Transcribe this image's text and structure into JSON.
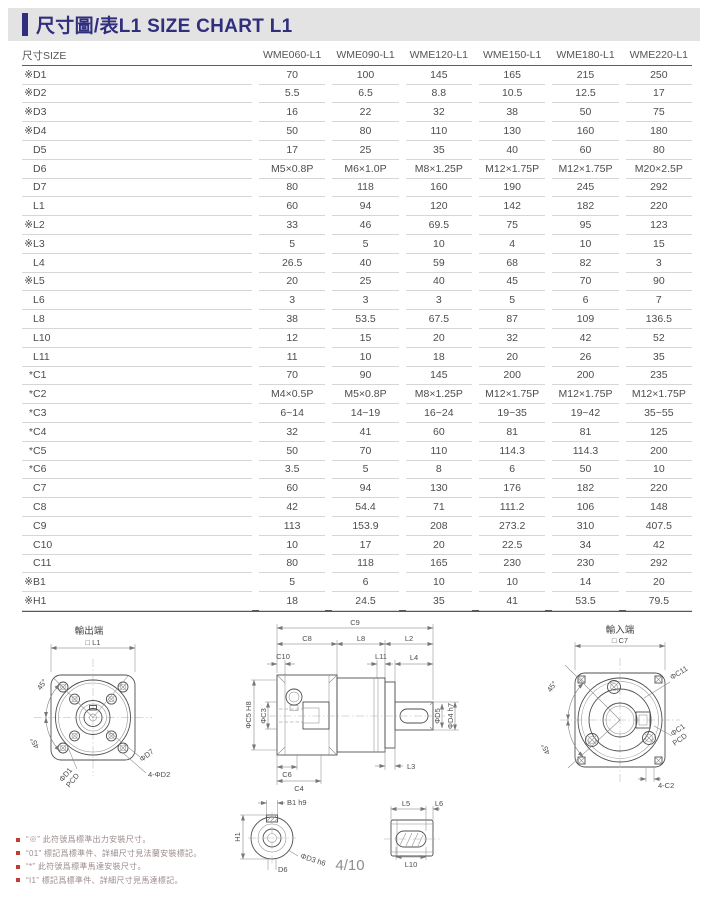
{
  "header": {
    "title": "尺寸圖/表L1 SIZE CHART L1"
  },
  "table": {
    "size_label": "尺寸SIZE",
    "columns": [
      "WME060-L1",
      "WME090-L1",
      "WME120-L1",
      "WME150-L1",
      "WME180-L1",
      "WME220-L1"
    ],
    "rows": [
      {
        "prefix": "※",
        "name": "D1",
        "values": [
          "70",
          "100",
          "145",
          "165",
          "215",
          "250"
        ]
      },
      {
        "prefix": "※",
        "name": "D2",
        "values": [
          "5.5",
          "6.5",
          "8.8",
          "10.5",
          "12.5",
          "17"
        ]
      },
      {
        "prefix": "※",
        "name": "D3",
        "values": [
          "16",
          "22",
          "32",
          "38",
          "50",
          "75"
        ]
      },
      {
        "prefix": "※",
        "name": "D4",
        "values": [
          "50",
          "80",
          "110",
          "130",
          "160",
          "180"
        ]
      },
      {
        "prefix": "",
        "name": "D5",
        "values": [
          "17",
          "25",
          "35",
          "40",
          "60",
          "80"
        ]
      },
      {
        "prefix": "",
        "name": "D6",
        "values": [
          "M5×0.8P",
          "M6×1.0P",
          "M8×1.25P",
          "M12×1.75P",
          "M12×1.75P",
          "M20×2.5P"
        ]
      },
      {
        "prefix": "",
        "name": "D7",
        "values": [
          "80",
          "118",
          "160",
          "190",
          "245",
          "292"
        ]
      },
      {
        "prefix": "",
        "name": "L1",
        "values": [
          "60",
          "94",
          "120",
          "142",
          "182",
          "220"
        ]
      },
      {
        "prefix": "※",
        "name": "L2",
        "values": [
          "33",
          "46",
          "69.5",
          "75",
          "95",
          "123"
        ]
      },
      {
        "prefix": "※",
        "name": "L3",
        "values": [
          "5",
          "5",
          "10",
          "4",
          "10",
          "15"
        ]
      },
      {
        "prefix": "",
        "name": "L4",
        "values": [
          "26.5",
          "40",
          "59",
          "68",
          "82",
          "3"
        ]
      },
      {
        "prefix": "※",
        "name": "L5",
        "values": [
          "20",
          "25",
          "40",
          "45",
          "70",
          "90"
        ]
      },
      {
        "prefix": "",
        "name": "L6",
        "values": [
          "3",
          "3",
          "3",
          "5",
          "6",
          "7"
        ]
      },
      {
        "prefix": "",
        "name": "L8",
        "values": [
          "38",
          "53.5",
          "67.5",
          "87",
          "109",
          "136.5"
        ]
      },
      {
        "prefix": "",
        "name": "L10",
        "values": [
          "12",
          "15",
          "20",
          "32",
          "42",
          "52"
        ]
      },
      {
        "prefix": "",
        "name": "L11",
        "values": [
          "11",
          "10",
          "18",
          "20",
          "26",
          "35"
        ]
      },
      {
        "prefix": "*",
        "name": "C1",
        "values": [
          "70",
          "90",
          "145",
          "200",
          "200",
          "235"
        ]
      },
      {
        "prefix": "*",
        "name": "C2",
        "values": [
          "M4×0.5P",
          "M5×0.8P",
          "M8×1.25P",
          "M12×1.75P",
          "M12×1.75P",
          "M12×1.75P"
        ]
      },
      {
        "prefix": "*",
        "name": "C3",
        "values": [
          "6~14",
          "14~19",
          "16~24",
          "19~35",
          "19~42",
          "35~55"
        ]
      },
      {
        "prefix": "*",
        "name": "C4",
        "values": [
          "32",
          "41",
          "60",
          "81",
          "81",
          "125"
        ]
      },
      {
        "prefix": "*",
        "name": "C5",
        "values": [
          "50",
          "70",
          "110",
          "114.3",
          "114.3",
          "200"
        ]
      },
      {
        "prefix": "*",
        "name": "C6",
        "values": [
          "3.5",
          "5",
          "8",
          "6",
          "50",
          "10"
        ]
      },
      {
        "prefix": "",
        "name": "C7",
        "values": [
          "60",
          "94",
          "130",
          "176",
          "182",
          "220"
        ]
      },
      {
        "prefix": "",
        "name": "C8",
        "values": [
          "42",
          "54.4",
          "71",
          "111.2",
          "106",
          "148"
        ]
      },
      {
        "prefix": "",
        "name": "C9",
        "values": [
          "113",
          "153.9",
          "208",
          "273.2",
          "310",
          "407.5"
        ]
      },
      {
        "prefix": "",
        "name": "C10",
        "values": [
          "10",
          "17",
          "20",
          "22.5",
          "34",
          "42"
        ]
      },
      {
        "prefix": "",
        "name": "C11",
        "values": [
          "80",
          "118",
          "165",
          "230",
          "230",
          "292"
        ]
      },
      {
        "prefix": "※",
        "name": "B1",
        "values": [
          "5",
          "6",
          "10",
          "10",
          "14",
          "20"
        ]
      },
      {
        "prefix": "※",
        "name": "H1",
        "values": [
          "18",
          "24.5",
          "35",
          "41",
          "53.5",
          "79.5"
        ]
      }
    ]
  },
  "drawings": {
    "output_view": {
      "title": "輸出端",
      "sq": "□ L1",
      "a45a": "45°",
      "a45b": "45°",
      "d1": "ΦD1",
      "pcd": "PCD",
      "d7": "ΦD7",
      "d2": "4-ΦD2"
    },
    "side_view": {
      "c9": "C9",
      "c8": "C8",
      "l8": "L8",
      "l2": "L2",
      "c10": "C10",
      "l11": "L11",
      "l4": "L4",
      "c5": "ΦC5 H8",
      "c3": "ΦC3",
      "d5": "ΦD5",
      "d4": "ΦD4 h7",
      "c6": "C6",
      "c4": "C4",
      "l3": "L3"
    },
    "input_view": {
      "title": "輸入端",
      "sq": "□ C7",
      "a45a": "45°",
      "a45b": "45°",
      "c11": "ΦC11",
      "c1": "ΦC1",
      "pcd": "PCD",
      "c2": "4-C2"
    },
    "shaft_section": {
      "b1": "B1 h9",
      "h1": "H1",
      "d3": "ΦD3 h6",
      "d6": "D6"
    },
    "key_detail": {
      "l5": "L5",
      "l6": "L6",
      "l10": "L10"
    }
  },
  "footnotes": [
    "“※” 此符號爲標準出力安裝尺寸。",
    "“01” 標記爲標準件、詳細尺寸見法蘭安裝標記。",
    "“*” 此符號爲標準馬達安裝尺寸。",
    "“I1” 標記爲標準件、詳細尺寸見馬達標記。"
  ],
  "page_number": "4/10"
}
